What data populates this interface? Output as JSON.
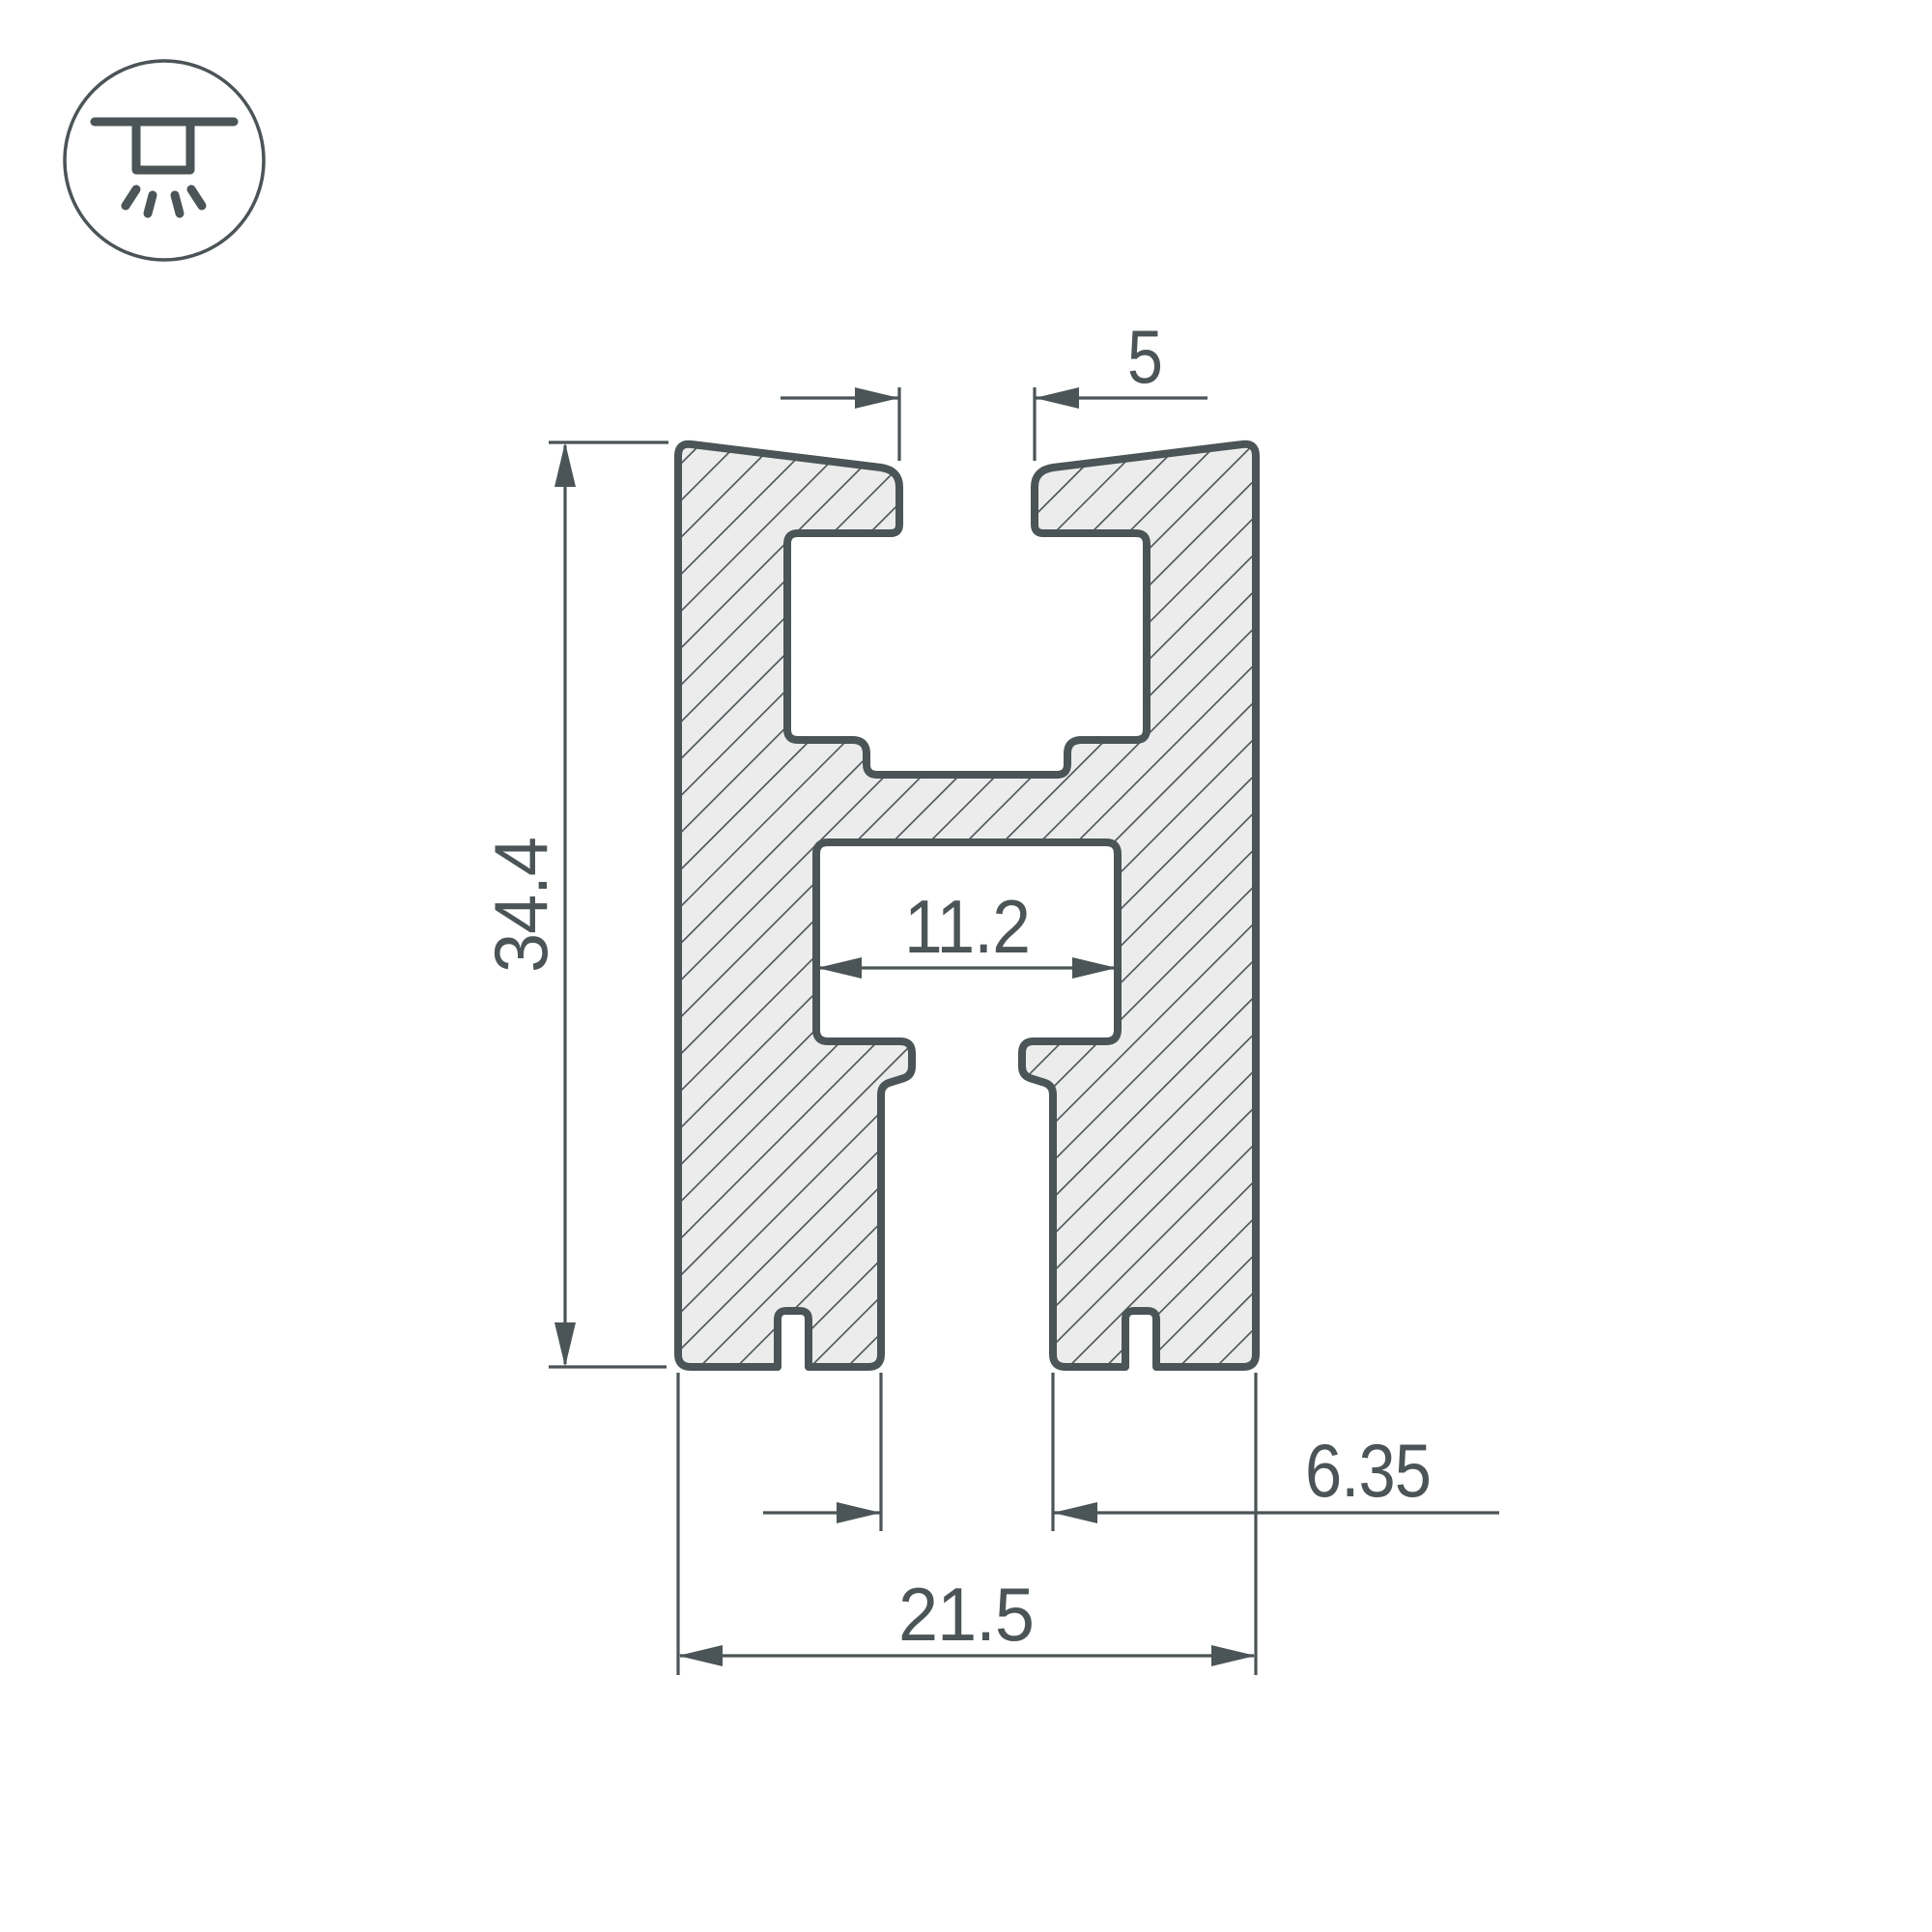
{
  "drawing": {
    "title": "LED profile cross-section technical drawing",
    "units": "mm",
    "dimensions": {
      "slot_width": {
        "value": "5"
      },
      "overall_height": {
        "value": "34.4"
      },
      "cavity_width": {
        "value": "11.2"
      },
      "channel_width": {
        "value": "6.35"
      },
      "overall_width": {
        "value": "21.5"
      }
    },
    "icon": {
      "name": "recessed-ceiling-light",
      "meaning": "built-in / recessed mounting with downward light"
    },
    "colors": {
      "line": "#4b5456",
      "material_fill": "#ececec",
      "background": "#ffffff"
    }
  }
}
